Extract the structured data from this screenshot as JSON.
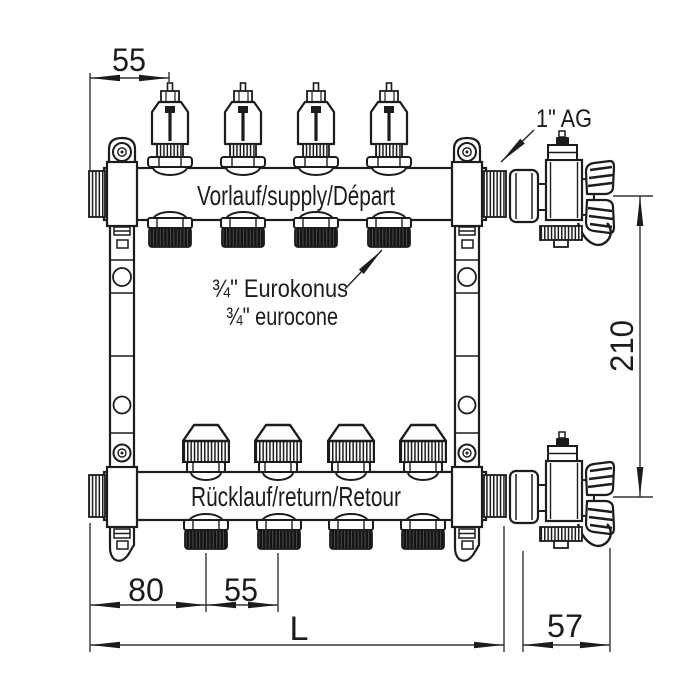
{
  "drawing": {
    "kind": "manifold-technical-drawing",
    "circuits": 4,
    "labels": {
      "supply": "Vorlauf/supply/Départ",
      "return": "Rücklauf/return/Retour",
      "eurokonus1": "¾\" Eurokonus",
      "eurokonus2": "¾\" eurocone",
      "thread": "1\" AG"
    },
    "dims": {
      "spacing_top": "55",
      "end_offset": "80",
      "spacing_bottom": "55",
      "length": "L",
      "valve_width": "57",
      "height": "210"
    },
    "colors": {
      "outline": "#1c1c1c",
      "dimension": "#333333",
      "thread_dark": "#141414",
      "background": "#ffffff"
    }
  }
}
